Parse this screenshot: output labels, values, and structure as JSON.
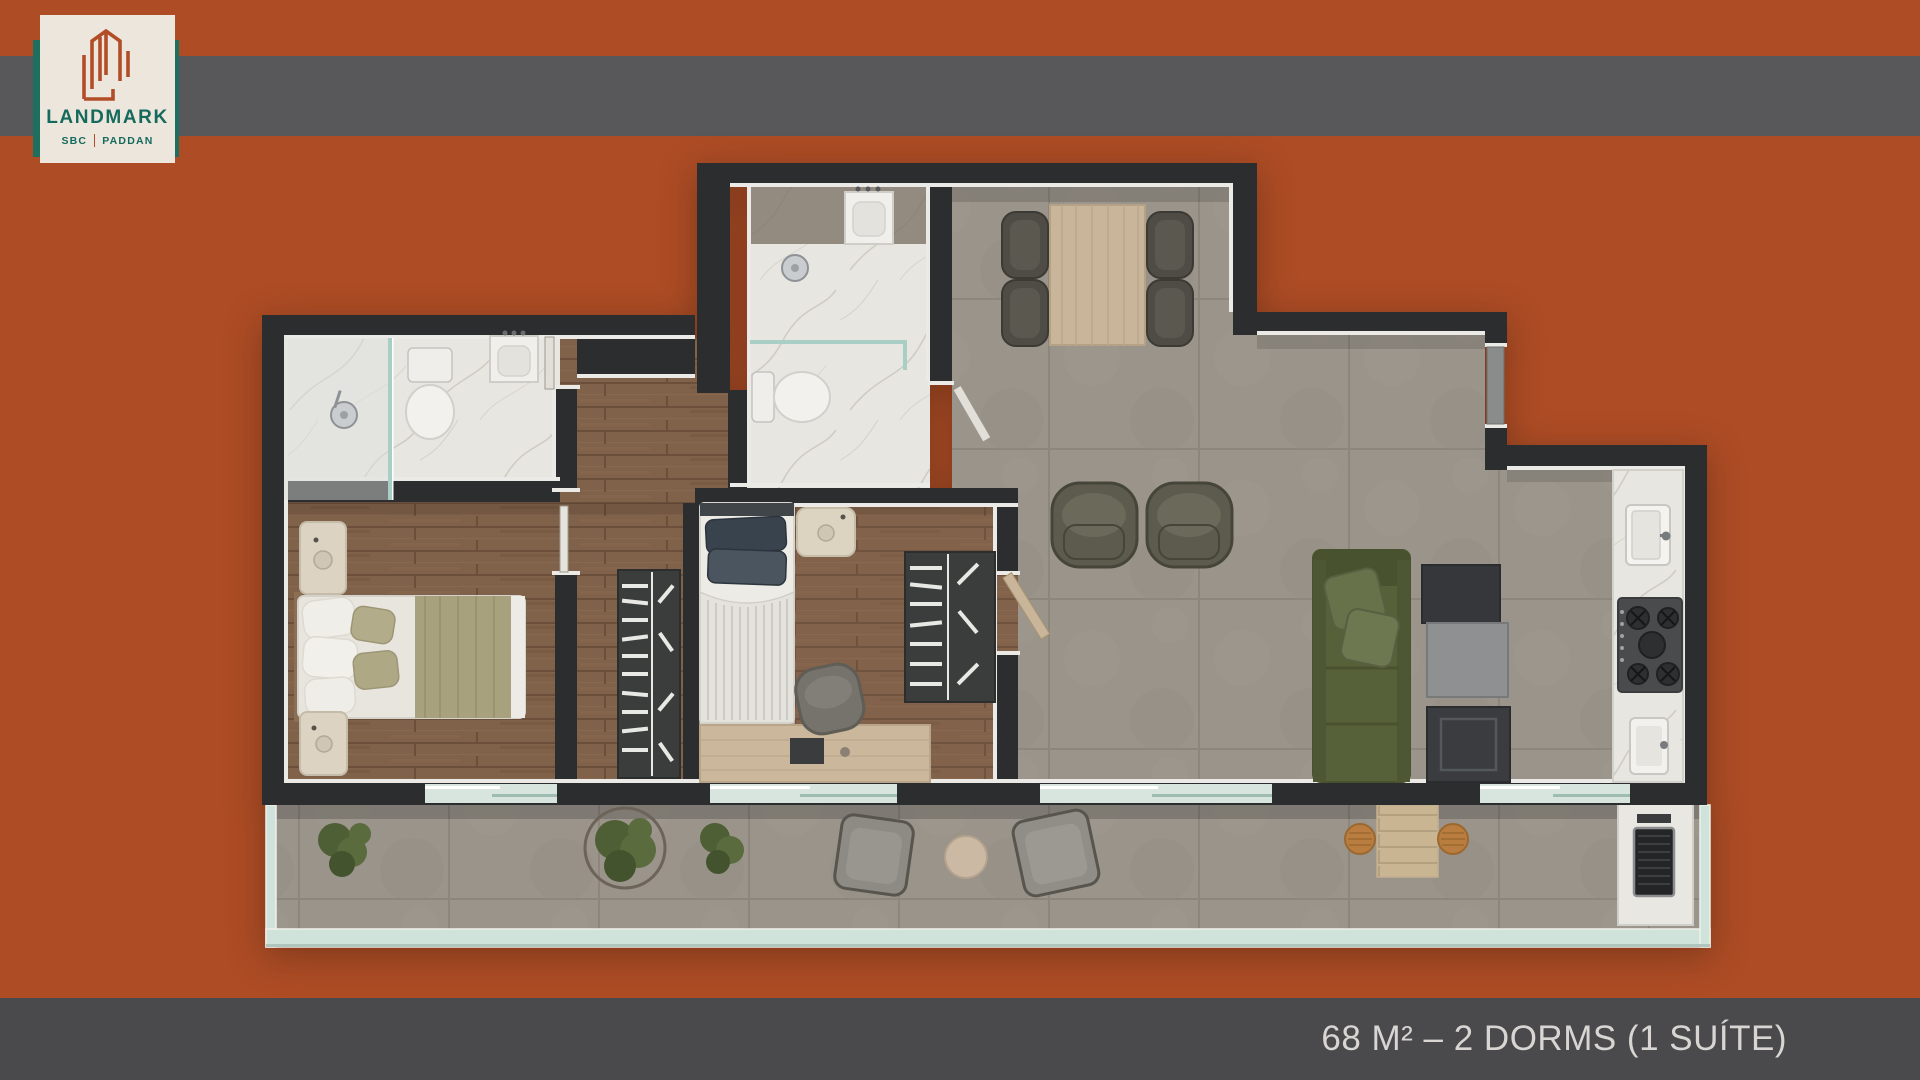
{
  "meta": {
    "kind": "real-estate floor plan marketing slide",
    "canvas": {
      "width": 1920,
      "height": 1080
    }
  },
  "background_color": "#AD4C25",
  "top_bar": {
    "color": "#58585A"
  },
  "bottom_bar": {
    "color": "#4A4A4C",
    "caption": "68 M² – 2 DORMS (1 SUÍTE)",
    "caption_color": "#D8D5D2"
  },
  "logo": {
    "brand": "LANDMARK",
    "sub_left": "SBC",
    "sub_right": "PADDAN",
    "card_color": "#EDE6DD",
    "accent_band_color": "#1E6F60",
    "text_color": "#156A5C",
    "icon": "building-outline-icon",
    "icon_color": "#B14E28"
  },
  "floor_plan": {
    "wall_color": "#2B2D2E",
    "trim_color": "#ECEAE6",
    "wood_floor_color": "#80614A",
    "tile_floor_color": "#9A948B",
    "marble_floor_color": "#E8E6E1",
    "glass_color": "#CFE3DB",
    "rooms": [
      {
        "name": "suite-bathroom",
        "fixtures": [
          "shower-head",
          "glass-partition",
          "toilet",
          "vanity-sink"
        ]
      },
      {
        "name": "bedroom-1-suite",
        "furniture": [
          "double-bed",
          "nightstand-with-lamp",
          "nightstand-with-lamp",
          "corridor-wardrobe"
        ]
      },
      {
        "name": "bathroom-2",
        "fixtures": [
          "vanity-sink",
          "shower-head",
          "glass-partition",
          "toilet"
        ]
      },
      {
        "name": "dining-area",
        "furniture": [
          "dining-table",
          "chair",
          "chair",
          "chair",
          "chair"
        ]
      },
      {
        "name": "living-room",
        "furniture": [
          "armchair",
          "armchair",
          "sofa",
          "tv-console",
          "sideboard",
          "cabinet"
        ]
      },
      {
        "name": "kitchen",
        "fixtures": [
          "counter",
          "sink",
          "cooktop",
          "service-sink"
        ],
        "entry": "entry-door"
      },
      {
        "name": "bedroom-2",
        "furniture": [
          "single-bed",
          "nightstand-with-lamp",
          "wardrobe",
          "desk",
          "desk-chair"
        ]
      },
      {
        "name": "balcony",
        "furniture": [
          "plant",
          "plant",
          "plant",
          "lounge-chair",
          "round-pouf",
          "lounge-chair",
          "bistro-table",
          "stool",
          "stool",
          "bbq-grill"
        ],
        "enclosure": "glass-railing"
      }
    ]
  }
}
